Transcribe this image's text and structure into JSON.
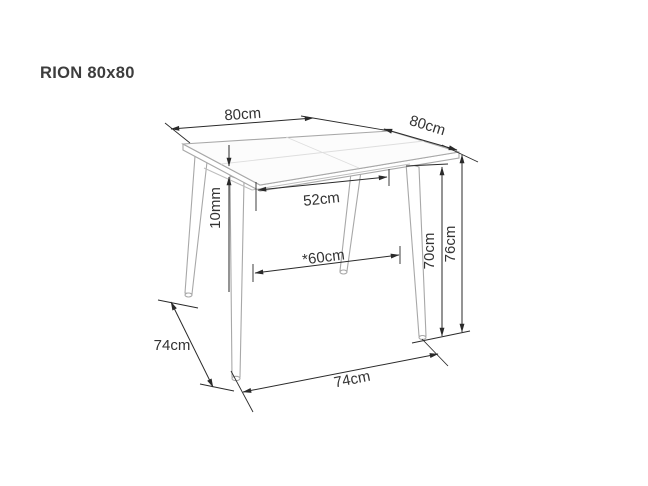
{
  "title": "RION 80x80",
  "diagram": {
    "type": "furniture-dimension-drawing",
    "dimensions": {
      "top_width": "80cm",
      "top_depth": "80cm",
      "between_legs_top": "52cm",
      "top_thickness": "10mm",
      "between_legs_floor": "*60cm",
      "height_under_top": "70cm",
      "total_height": "76cm",
      "base_depth": "74cm",
      "base_width": "74cm"
    },
    "colors": {
      "background": "#ffffff",
      "dimension_line": "#2a2a2a",
      "table_outline": "#a8a8a8",
      "text": "#333333"
    }
  }
}
